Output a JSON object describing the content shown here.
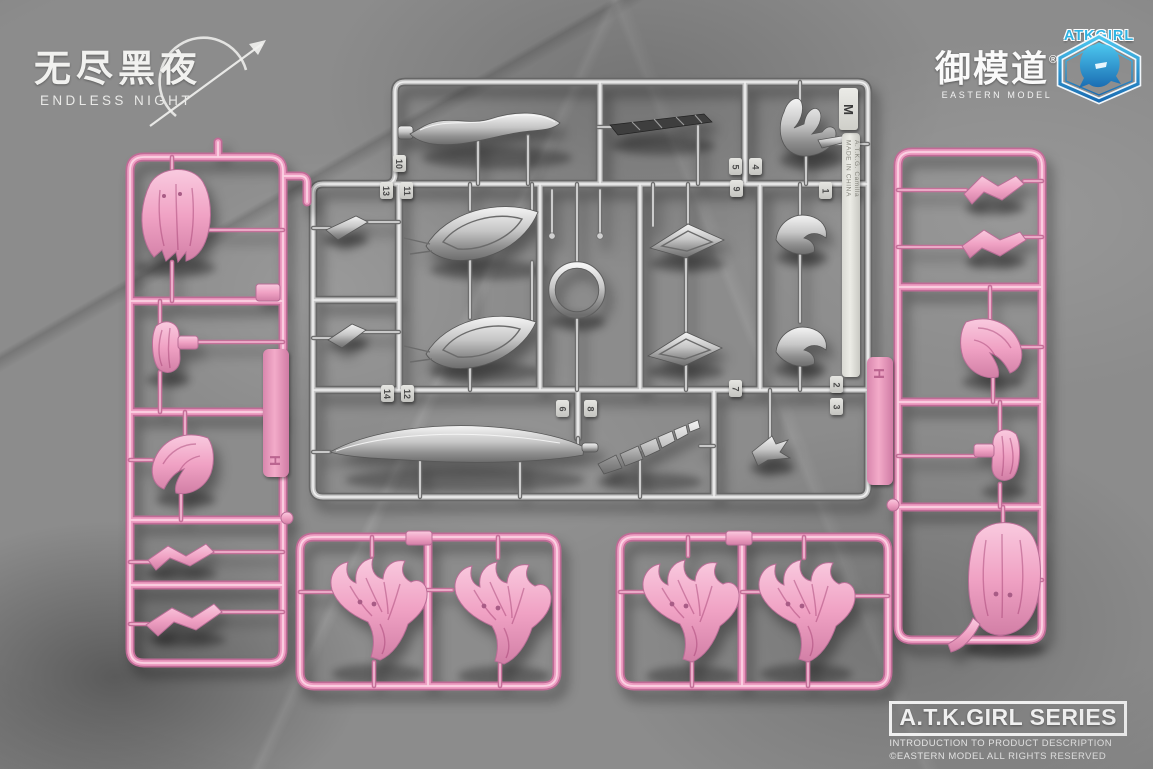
{
  "branding": {
    "endless_night": {
      "title_cn": "无尽黑夜",
      "subtitle_en": "ENDLESS NIGHT",
      "icon": "crescent-moon-arrow-icon"
    },
    "eastern_model": {
      "name_cn": "御模道",
      "registered_mark": "®",
      "name_en": "EASTERN MODEL"
    },
    "atkgirl_badge": {
      "text": "ATKGIRL",
      "icon": "anime-girl-head-hexagon-icon",
      "color_primary": "#2fb3e3",
      "color_dark": "#1a6cb2"
    }
  },
  "footer": {
    "series_title": "A.T.K.GIRL SERIES",
    "line1": "INTRODUCTION TO PRODUCT DESCRIPTION",
    "line2": "©EASTERN MODEL ALL RIGHTS RESERVED"
  },
  "sprues": {
    "silver_runner": {
      "code": "M",
      "label_vertical_line1": "A.T.K.G. Camilla",
      "label_vertical_line2": "MADE IN CHINA",
      "part_numbers": [
        "10",
        "13",
        "11",
        "5",
        "4",
        "9",
        "1",
        "14",
        "12",
        "6",
        "8",
        "7",
        "2",
        "3"
      ],
      "color": "#bdbdbd"
    },
    "pink_runner_left": {
      "code": "H",
      "color": "#ef9fc3"
    },
    "pink_runner_right": {
      "code": "H",
      "color": "#ef9fc3"
    },
    "pink_runner_bottom_left": {
      "color": "#ef9fc3"
    },
    "pink_runner_bottom_right": {
      "color": "#ef9fc3"
    }
  },
  "colors": {
    "background_marble": "#8c8c8c"
  }
}
